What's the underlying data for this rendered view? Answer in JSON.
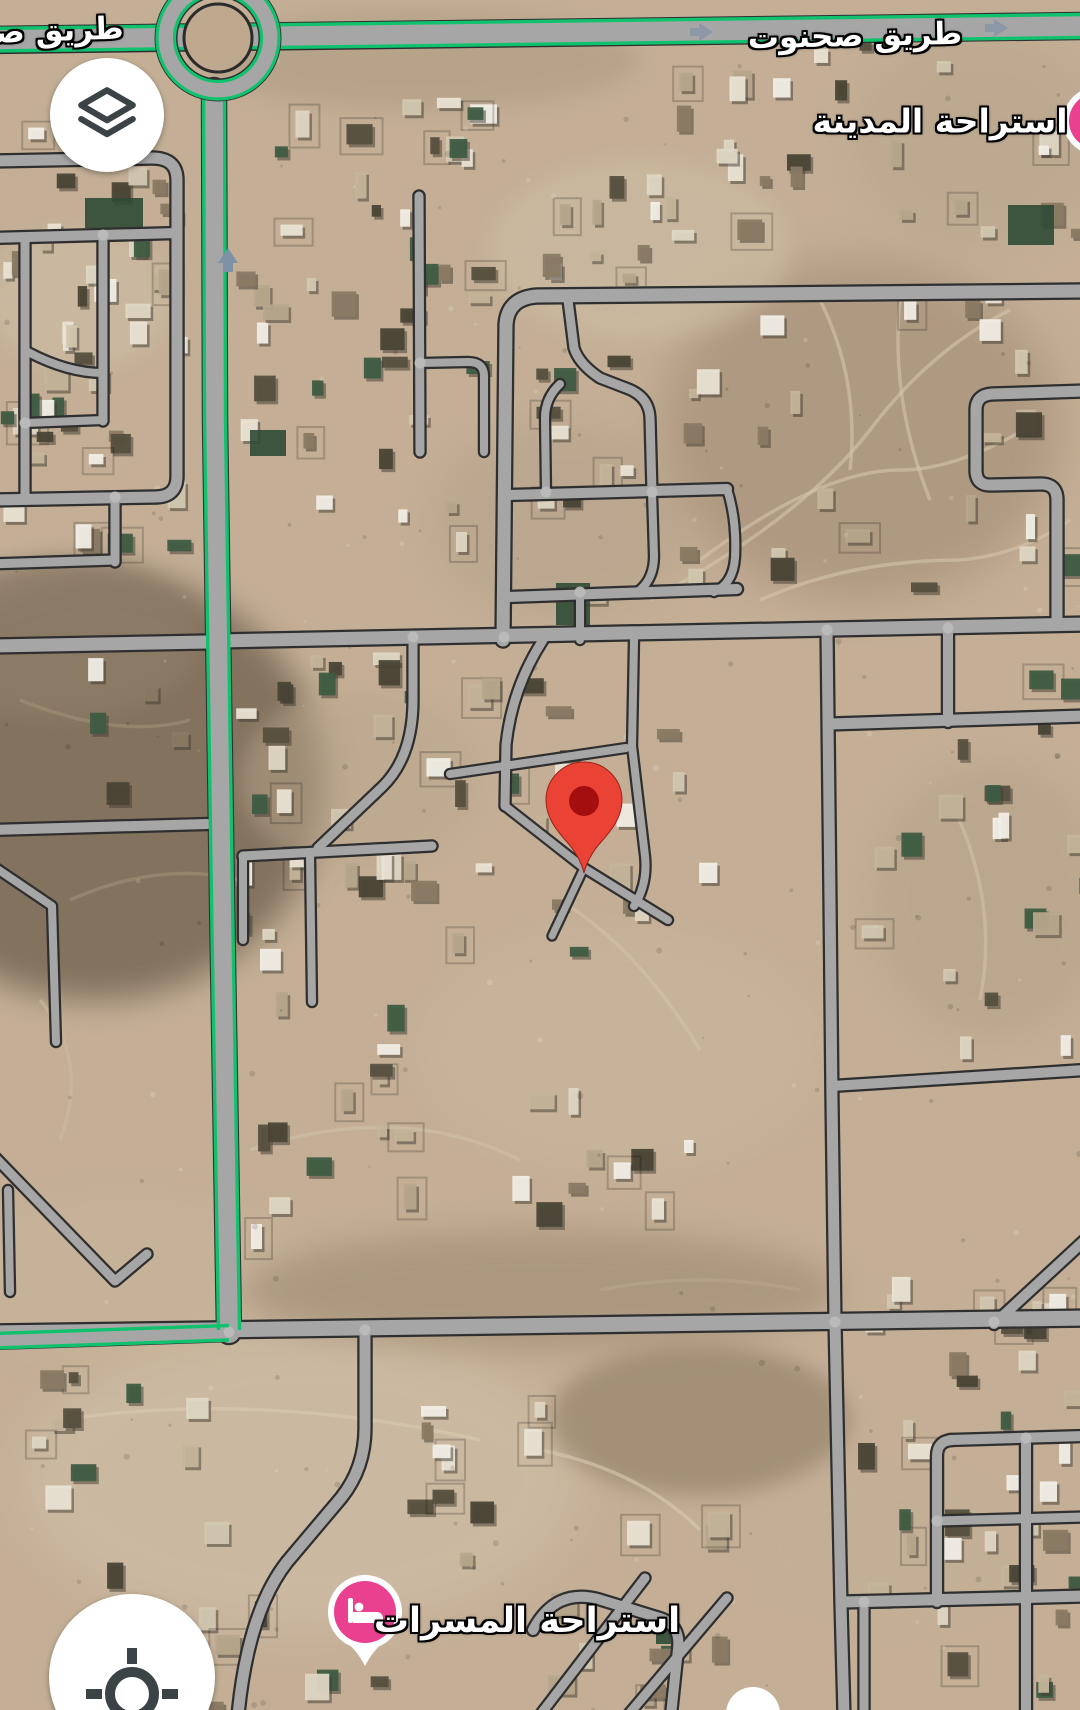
{
  "map": {
    "labels": {
      "road_main": "طريق صحنوت",
      "road_left_partial": "طريق صح",
      "poi_top": "استراحة المدينة",
      "poi_bottom": "استراحة المسرات"
    },
    "markers": [
      {
        "name": "lodging-marker-top-right",
        "icon": "bed-icon",
        "label": "استراحة المدينة"
      },
      {
        "name": "lodging-marker-bottom",
        "icon": "bed-icon",
        "label": "استراحة المسرات"
      },
      {
        "name": "destination-pin",
        "icon": "map-pin"
      }
    ],
    "colors": {
      "highway_green": "#10C26E",
      "road_fill": "#A6A6A6",
      "road_casing": "#2F2F2F",
      "terrain_base": "#C4AF96",
      "pin_red": "#EA4335",
      "pin_inner": "#A50E0E",
      "poi_pink": "#E9418F",
      "button_bg": "#FFFFFF",
      "button_icon": "#3C4347",
      "label_text": "#FFFFFF",
      "label_outline": "#000000"
    }
  },
  "controls": {
    "layers_button": {
      "icon": "layers-icon"
    },
    "my_location_button": {
      "icon": "my-location-icon"
    }
  }
}
